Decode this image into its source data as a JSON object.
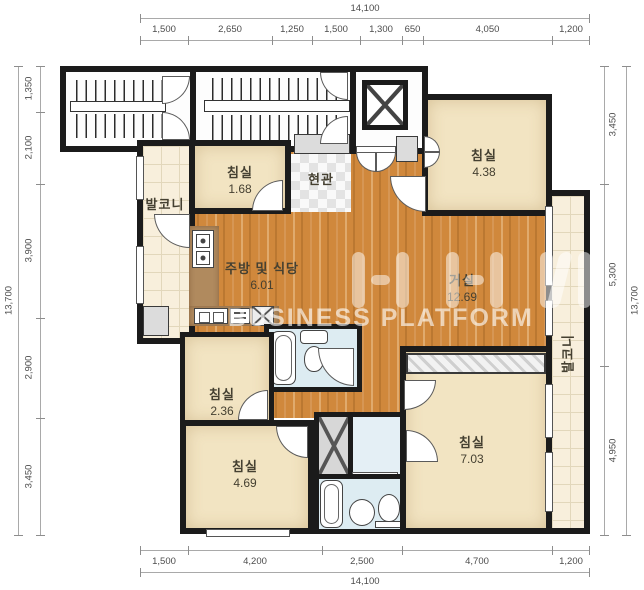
{
  "title": "apartment-floor-plan",
  "watermark": {
    "text": "BUSINESS PLATFORM"
  },
  "dims": {
    "top": {
      "total": "14,100",
      "segments": [
        "1,500",
        "2,650",
        "1,250",
        "1,500",
        "1,300",
        "650",
        "4,050",
        "1,200"
      ]
    },
    "bottom": {
      "total": "14,100",
      "segments": [
        "1,500",
        "4,200",
        "2,500",
        "4,700",
        "1,200"
      ]
    },
    "left": {
      "total": "13,700",
      "segments": [
        "1,350",
        "2,100",
        "3,900",
        "2,900",
        "3,450"
      ]
    },
    "right": {
      "total": "13,700",
      "segments": [
        "3,450",
        "5,300",
        "4,950"
      ]
    }
  },
  "rooms": {
    "bedroom_tl": {
      "name": "침실",
      "area": "1.68"
    },
    "bedroom_tr": {
      "name": "침실",
      "area": "4.38"
    },
    "entrance": {
      "name": "현관"
    },
    "kitchen": {
      "name": "주방 및 식당",
      "area": "6.01"
    },
    "living": {
      "name": "거실",
      "area": "12.69"
    },
    "bedroom_ml": {
      "name": "침실",
      "area": "2.36"
    },
    "bedroom_bl": {
      "name": "침실",
      "area": "4.69"
    },
    "bedroom_br": {
      "name": "침실",
      "area": "7.03"
    },
    "balcony_left": {
      "name": "발코니"
    },
    "balcony_right": {
      "name": "발코니"
    }
  },
  "colors": {
    "wall": "#1b1b1b",
    "wood": "#d0883c",
    "bedroom": "#f2e4c2",
    "bath": "#ddecf2",
    "tile": "#f8efdc",
    "label": "#454031"
  }
}
